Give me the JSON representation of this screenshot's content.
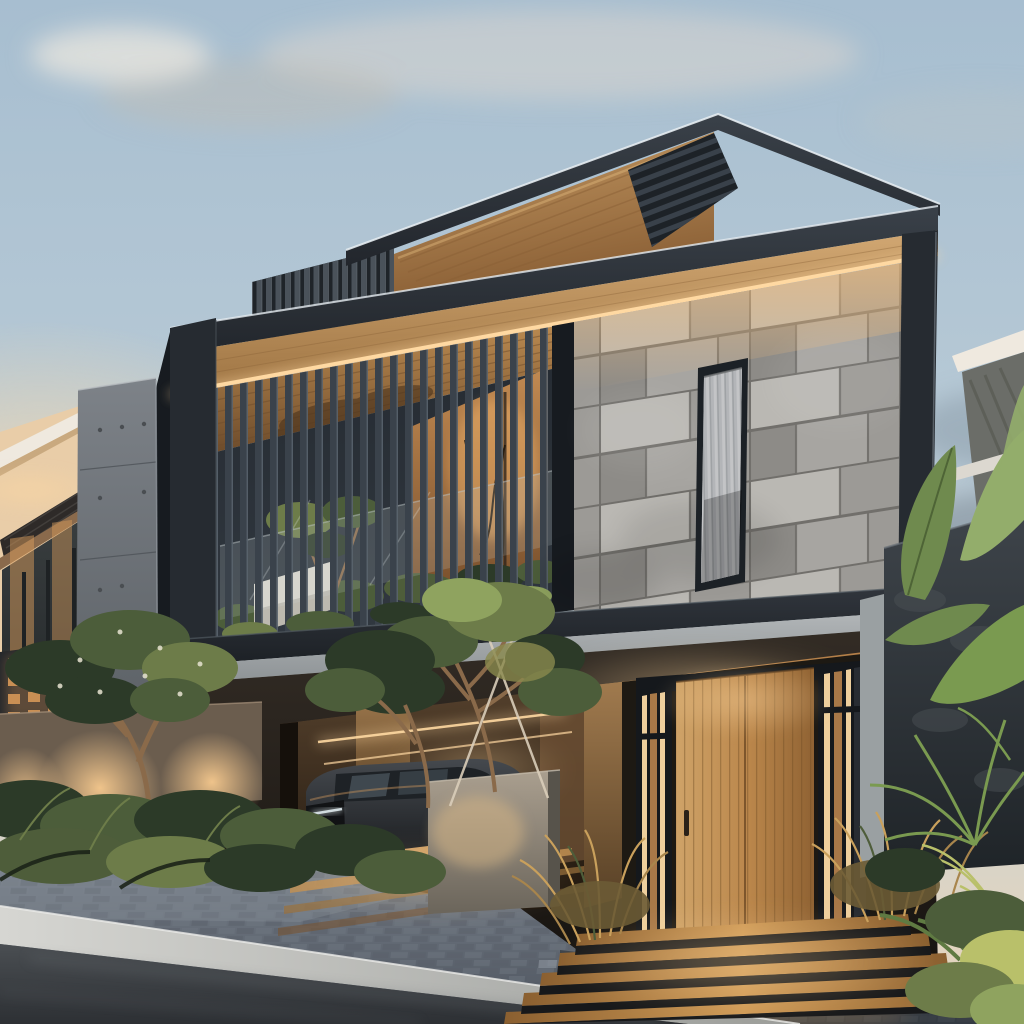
{
  "scene": {
    "type": "photograph",
    "description": "Modern two-storey tropical house at dusk: charcoal-framed upper floor with slatted balcony and grey marble patchwork feature wall, warm timber soffits with LED strips, roof-deck louver screens, carport with dark SUV, timber pivot entry door with lit steps, landscaped garden walls with up-lights, paver driveway and asphalt street",
    "time_of_day": "dusk"
  },
  "details": {
    "entry_step_count": 5,
    "driveway_light_strip_count": 4,
    "garden_uplight_count": 3,
    "stone_window_count": 1,
    "parked_vehicle_count": 1,
    "balcony_window_mullion_count": 2
  },
  "palette": {
    "sky_top": "#a7bed0",
    "sky_mid": "#b8cad6",
    "sky_low": "#ccd2d2",
    "horizon_warm": "#e8d5ba",
    "horizon_peach": "#f6d9ae",
    "cloud_light": "#ded8cf",
    "cloud_warm": "#c2bcb4",
    "cloud_dusk": "#7e8c98",
    "cloud_gray": "#8a9aa8",
    "rim_light": "#e6ecf1",
    "charcoal_band_light": "#3a4149",
    "charcoal_band_dark": "#22262c",
    "charcoal_frame": "#262b31",
    "frame_deep": "#171b20",
    "band2_light": "#31363d",
    "band2_dark": "#1c2025",
    "soffit_light": "#d2a873",
    "soffit_dark": "#9d7342",
    "led_glow": "#ffd9a2",
    "panel_wood_light": "#c59a64",
    "panel_wood_dark": "#8a5f35",
    "louver_dark": "#1d2227",
    "louver_stripe": "#39414a",
    "screen_dark": "#1f2429",
    "screen_bar": "#4a525a",
    "slat_bar": "#3a424b",
    "slat_edge": "#59636d",
    "balcony_ceiling_light": "#b98950",
    "balcony_ceiling_dark": "#6e4c2b",
    "ceiling_shadow": "#452f1a",
    "interior_dark": "#262c33",
    "interior_dark2": "#313840",
    "window_warm": "#d29455",
    "window_warm_dark": "#7d4f28",
    "window_core": "#f7b86e",
    "glass_tint": "#cfd8da",
    "planter_white": "#d9d6cc",
    "planter_shade": "#b4b1a8",
    "stone_base": "#a7a5a1",
    "stone_light": "#bcbab5",
    "stone_mid": "#9b9995",
    "stone_dark": "#8a8884",
    "stone_joint": "#6b6965",
    "stone_glow": "#f0bc7c",
    "window_frame": "#1c2126",
    "curtain_light": "#c3c4c6",
    "curtain_dark": "#9fa2a5",
    "slab_light": "#b3b7b9",
    "slab_dark": "#8d9295",
    "ground_wall_light": "#332c25",
    "ground_wall_dark": "#15120f",
    "porch_wood_light": "#b8824a",
    "porch_wood_dark": "#6b4726",
    "carport_light": "#54402c",
    "carport_dark": "#1d150d",
    "tan_wall_light": "#a07a4e",
    "tan_wall_dark": "#574026",
    "car_top": "#45494e",
    "car_dark": "#141619",
    "car_glass": "#1e2226",
    "car_window_reflect": "#8fa3b0",
    "plate_gray": "#c9cdcf",
    "drl_white": "#d8e2e6",
    "door_light": "#cfa368",
    "door_mid": "#b9854a",
    "door_dark": "#8f6233",
    "door_seam": "#6e4a24",
    "handle_dark": "#2a2118",
    "mullion_black": "#15181c",
    "glazing_strip_warm": "#eecf9d",
    "glazing_wood": "#a87848",
    "step_light": "#cf9a56",
    "step_dark": "#8a5f30",
    "riser_dark": "#17181a",
    "grass_gold": "#c9a05c",
    "grass_gold_dark": "#a8854c",
    "fern_green": "#4e5d3a",
    "leaf_dark": "#2c3a28",
    "leaf_mid": "#4c5d3a",
    "leaf_light": "#6d7c49",
    "leaf_bright": "#8fa35f",
    "banana_green": "#6f8a4e",
    "banana_light": "#93ad6b",
    "palm_green": "#7a9a50",
    "plant_yellow": "#b9c06a",
    "trunk_brown": "#8a6a4a",
    "stake_light": "#d9cdb9",
    "cube_light": "#aa9f8f",
    "cube_dark": "#6b655b",
    "cube_warm": "#d9b886",
    "garden_wall": "#6b5d4e",
    "garden_wall_top": "#a8937c",
    "uplight_warm": "#f6c98e",
    "breeze_dark": "#23262a",
    "breeze_glow": "#c98f54",
    "pillar_light": "#7d8288",
    "pillar_dark": "#565b60",
    "pillar_dot": "#4a4e52",
    "pillar_seam": "#4e5358",
    "neighbor_cream": "#e9cda8",
    "neighbor_canopy": "#efe9df",
    "neighbor_canopy_warm": "#c9a97f",
    "neighbor_roof": "#2e2a28",
    "neighbor_eave": "#8a6a4c",
    "neighbor_glass": "#3a3f40",
    "neighbor_glass_dark": "#24282a",
    "neighbor_glow": "#d79b5c",
    "darkstone_light": "#3e444a",
    "darkstone_dark": "#1f2428",
    "stone_panel_gray": "#9aa0a2",
    "paver_light": "#7d8590",
    "paver_dark": "#4a515b",
    "paver_tile_a": "#6e7580",
    "paver_tile_b": "#596069",
    "paver_joint": "#3f454d",
    "curb_light": "#d6d6d2",
    "curb_dark": "#9a9c99",
    "road_light": "#4a4e52",
    "road_dark": "#2d3034",
    "shadow_black": "#000000"
  }
}
